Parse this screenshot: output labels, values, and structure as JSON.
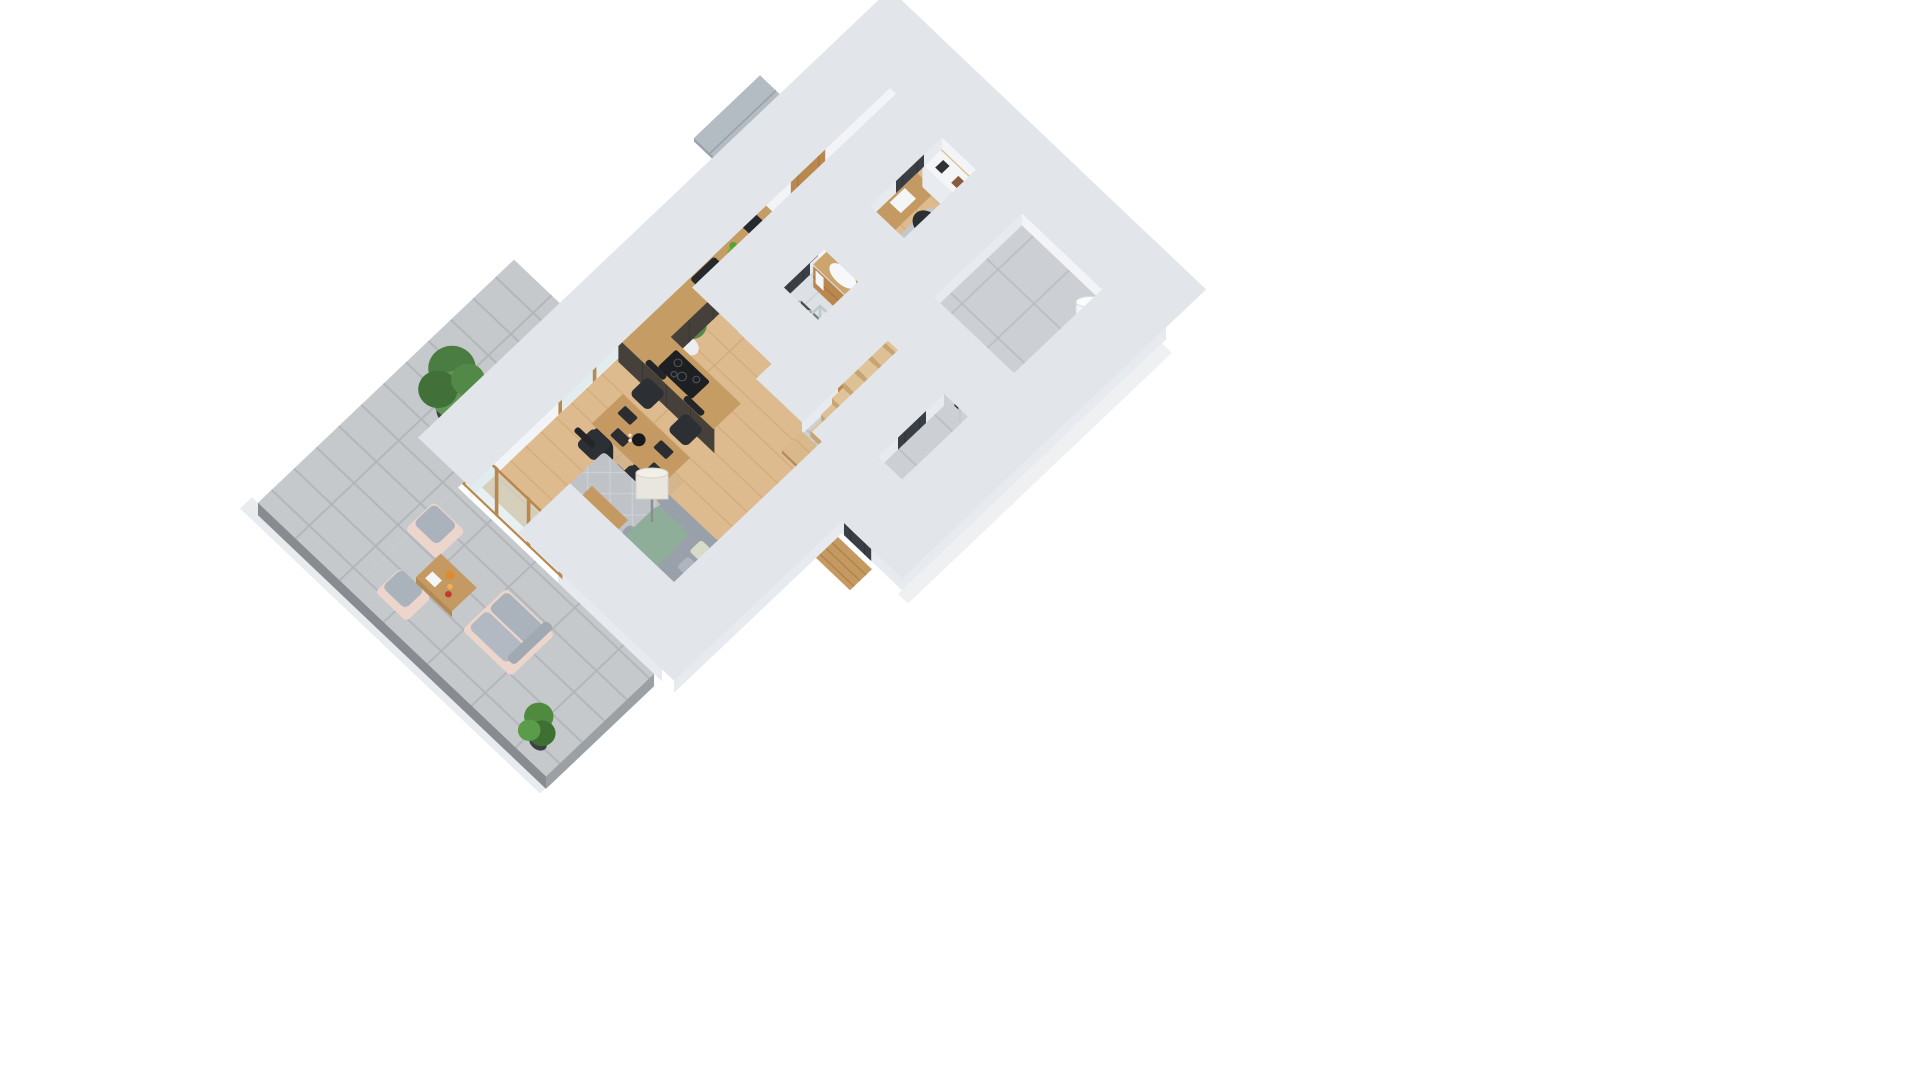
{
  "meta": {
    "title": "3D isometric dollhouse cutaway render of a single-storey house floor plan",
    "view": "isometric bird's-eye, walls cut at ~1 m height",
    "background": "#ffffff"
  },
  "palette": {
    "pageBg": "#ffffff",
    "wallTop": "#fbfcfd",
    "wallLight": "#f2f4f7",
    "wallShade": "#e7eaee",
    "woodFloor": "#ddbb8e",
    "plankLine": "#cfa877",
    "grayTile": "#ccd0d5",
    "bathTile": "#dde0e4",
    "pavers": "#c6c9cc",
    "terraceEdge": "#888c90",
    "oak": "#c99a5f",
    "oakDark": "#b9884f",
    "counterTop": "#c59c63",
    "counterDark": "#46403a",
    "graphite": "#3a3f46",
    "stairsWood": "#d9b98c",
    "sofaGray": "#9aa1ab",
    "rugGray": "#bfc3c8",
    "throwGreen": "#8fae9a",
    "plantGreen": "#4a7d42",
    "copper": "#c77f4f",
    "chrome": "#c9ced3",
    "whiteGoods": "#f4f5f7",
    "outdoorBlush": "#ecd6cb",
    "outdoorCushion": "#aab2bc",
    "glassBlue": "#cfe3e8",
    "porchConcrete": "#b3bcc3",
    "marble": "#e9e7e3",
    "screenDark": "#141619",
    "benchGray": "#b6bac0",
    "wardrobeGray": "#9aa0a8",
    "sofaGreenDark": "#2e4a3a"
  },
  "rooms": [
    {
      "name": "Kitchen",
      "features": [
        "L-shaped dark base units",
        "oak worktop",
        "black undermount sink with black tap",
        "black induction hob",
        "oak wall cabinets",
        "window with dark venetian blind",
        "tall graphite cabinet",
        "bowl of green apples",
        "black coffee machine"
      ]
    },
    {
      "name": "Dining area",
      "features": [
        "oak dining table",
        "four black upholstered chairs",
        "black placemats",
        "black bowl centrepiece",
        "candlesticks"
      ]
    },
    {
      "name": "Living room",
      "features": [
        "grey fabric sofa with sage green throw",
        "patterned cushion",
        "white drum floor lamp",
        "oak coffee table with magazine",
        "grey patterned rug",
        "marble media wall with mounted TV",
        "graphite media console",
        "white router",
        "houseplants in pots"
      ]
    },
    {
      "name": "Hallway",
      "features": [
        "wooden front door",
        "concrete entrance porch outside",
        "open grey wardrobe with hanging clothes",
        "grey upholstered bench",
        "pairs of shoes",
        "monstera plant in white pot"
      ]
    },
    {
      "name": "Home office",
      "features": [
        "oak desk with laptop",
        "black swivel chair",
        "white marble-top sideboard with books",
        "graphite open bookcase",
        "dark green two-seat sofa",
        "window with dark venetian blind",
        "row of small picture frames on wall",
        "potted palm"
      ]
    },
    {
      "name": "Bathroom",
      "features": [
        "oak vanity with white basin",
        "round copper-framed mirror",
        "white towel",
        "glass shower enclosure with chrome frame",
        "dark diamond-pattern mat",
        "wood feature wall",
        "light grey tile floor"
      ]
    },
    {
      "name": "Entry / mudroom",
      "features": [
        "grey stone tile floor",
        "grey tiled wall",
        "chrome ladder towel radiator",
        "white water-heater cylinder",
        "three wall hooks",
        "dark graphite interior doors"
      ]
    },
    {
      "name": "Staircase",
      "features": [
        "oak treads descending to hall",
        "white stringer walls",
        "oak landing platform",
        "dark side-entrance door",
        "outdoor wooden step"
      ]
    },
    {
      "name": "Terrace",
      "features": [
        "grey concrete paver floor",
        "darker platform edge",
        "outdoor loveseat with blush frame and grey cushions",
        "two outdoor armchairs",
        "wooden coffee table with juice pitcher, glasses, red flowers and open book",
        "potted tree",
        "potted fern",
        "oak-framed corner sliding glass doors",
        "freestanding white privacy wall"
      ]
    }
  ]
}
